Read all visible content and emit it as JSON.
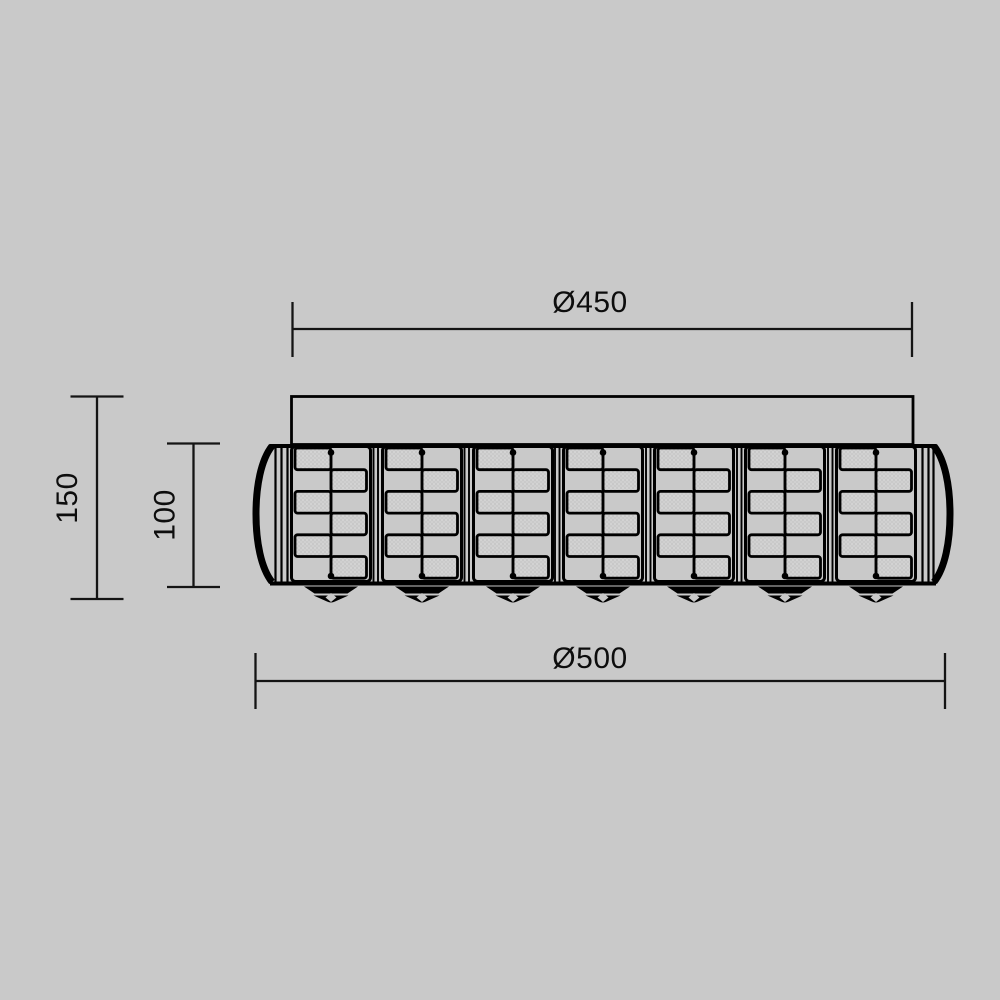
{
  "drawing": {
    "background_color": "#c9c9c9",
    "line_color": "#000000",
    "dimension_line_color": "#141414",
    "crystal_fill_color": "#d3d3d3",
    "dimensions": {
      "diameter_top": "Ø450",
      "diameter_bottom": "Ø500",
      "height_overall": "150",
      "height_shade": "100"
    },
    "fixture": {
      "crystal_panels": 7,
      "cells_per_panel": 6,
      "finials": 7
    }
  }
}
